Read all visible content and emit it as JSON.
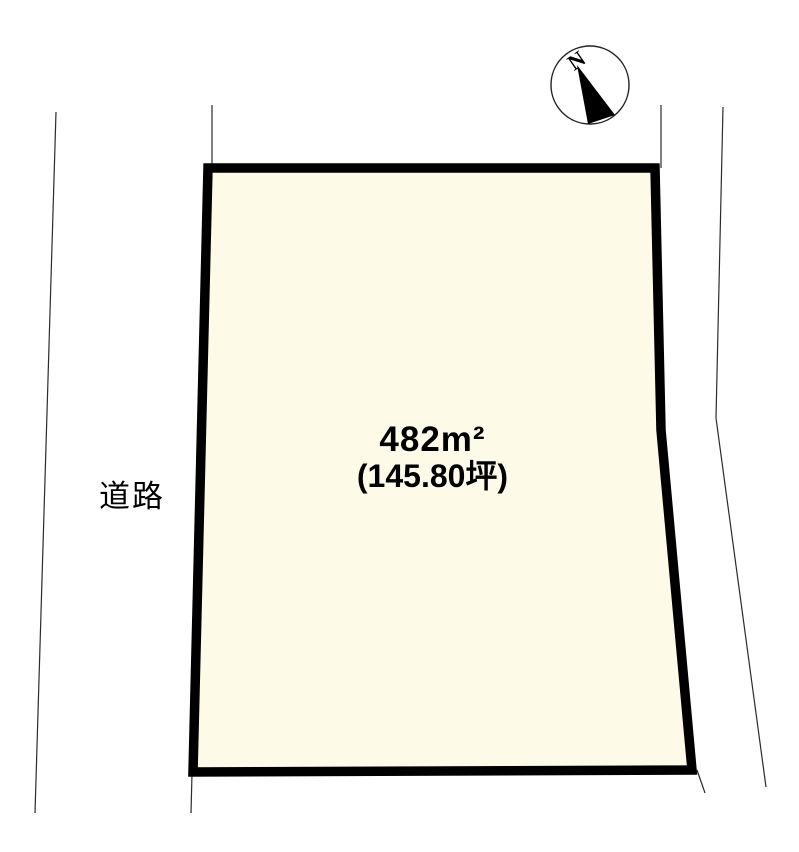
{
  "diagram": {
    "type": "land-plot-map",
    "background_color": "#ffffff"
  },
  "plot": {
    "area_sqm_label": "482m²",
    "area_sqm_value": 482,
    "area_tsubo_label": "(145.80坪)",
    "area_tsubo_value": 145.8,
    "fill_color": "#fdfbe8",
    "border_color": "#000000"
  },
  "road": {
    "label": "道路",
    "line_color": "#2b2b2b"
  },
  "compass": {
    "north_label": "N",
    "needle_color": "#000000"
  }
}
